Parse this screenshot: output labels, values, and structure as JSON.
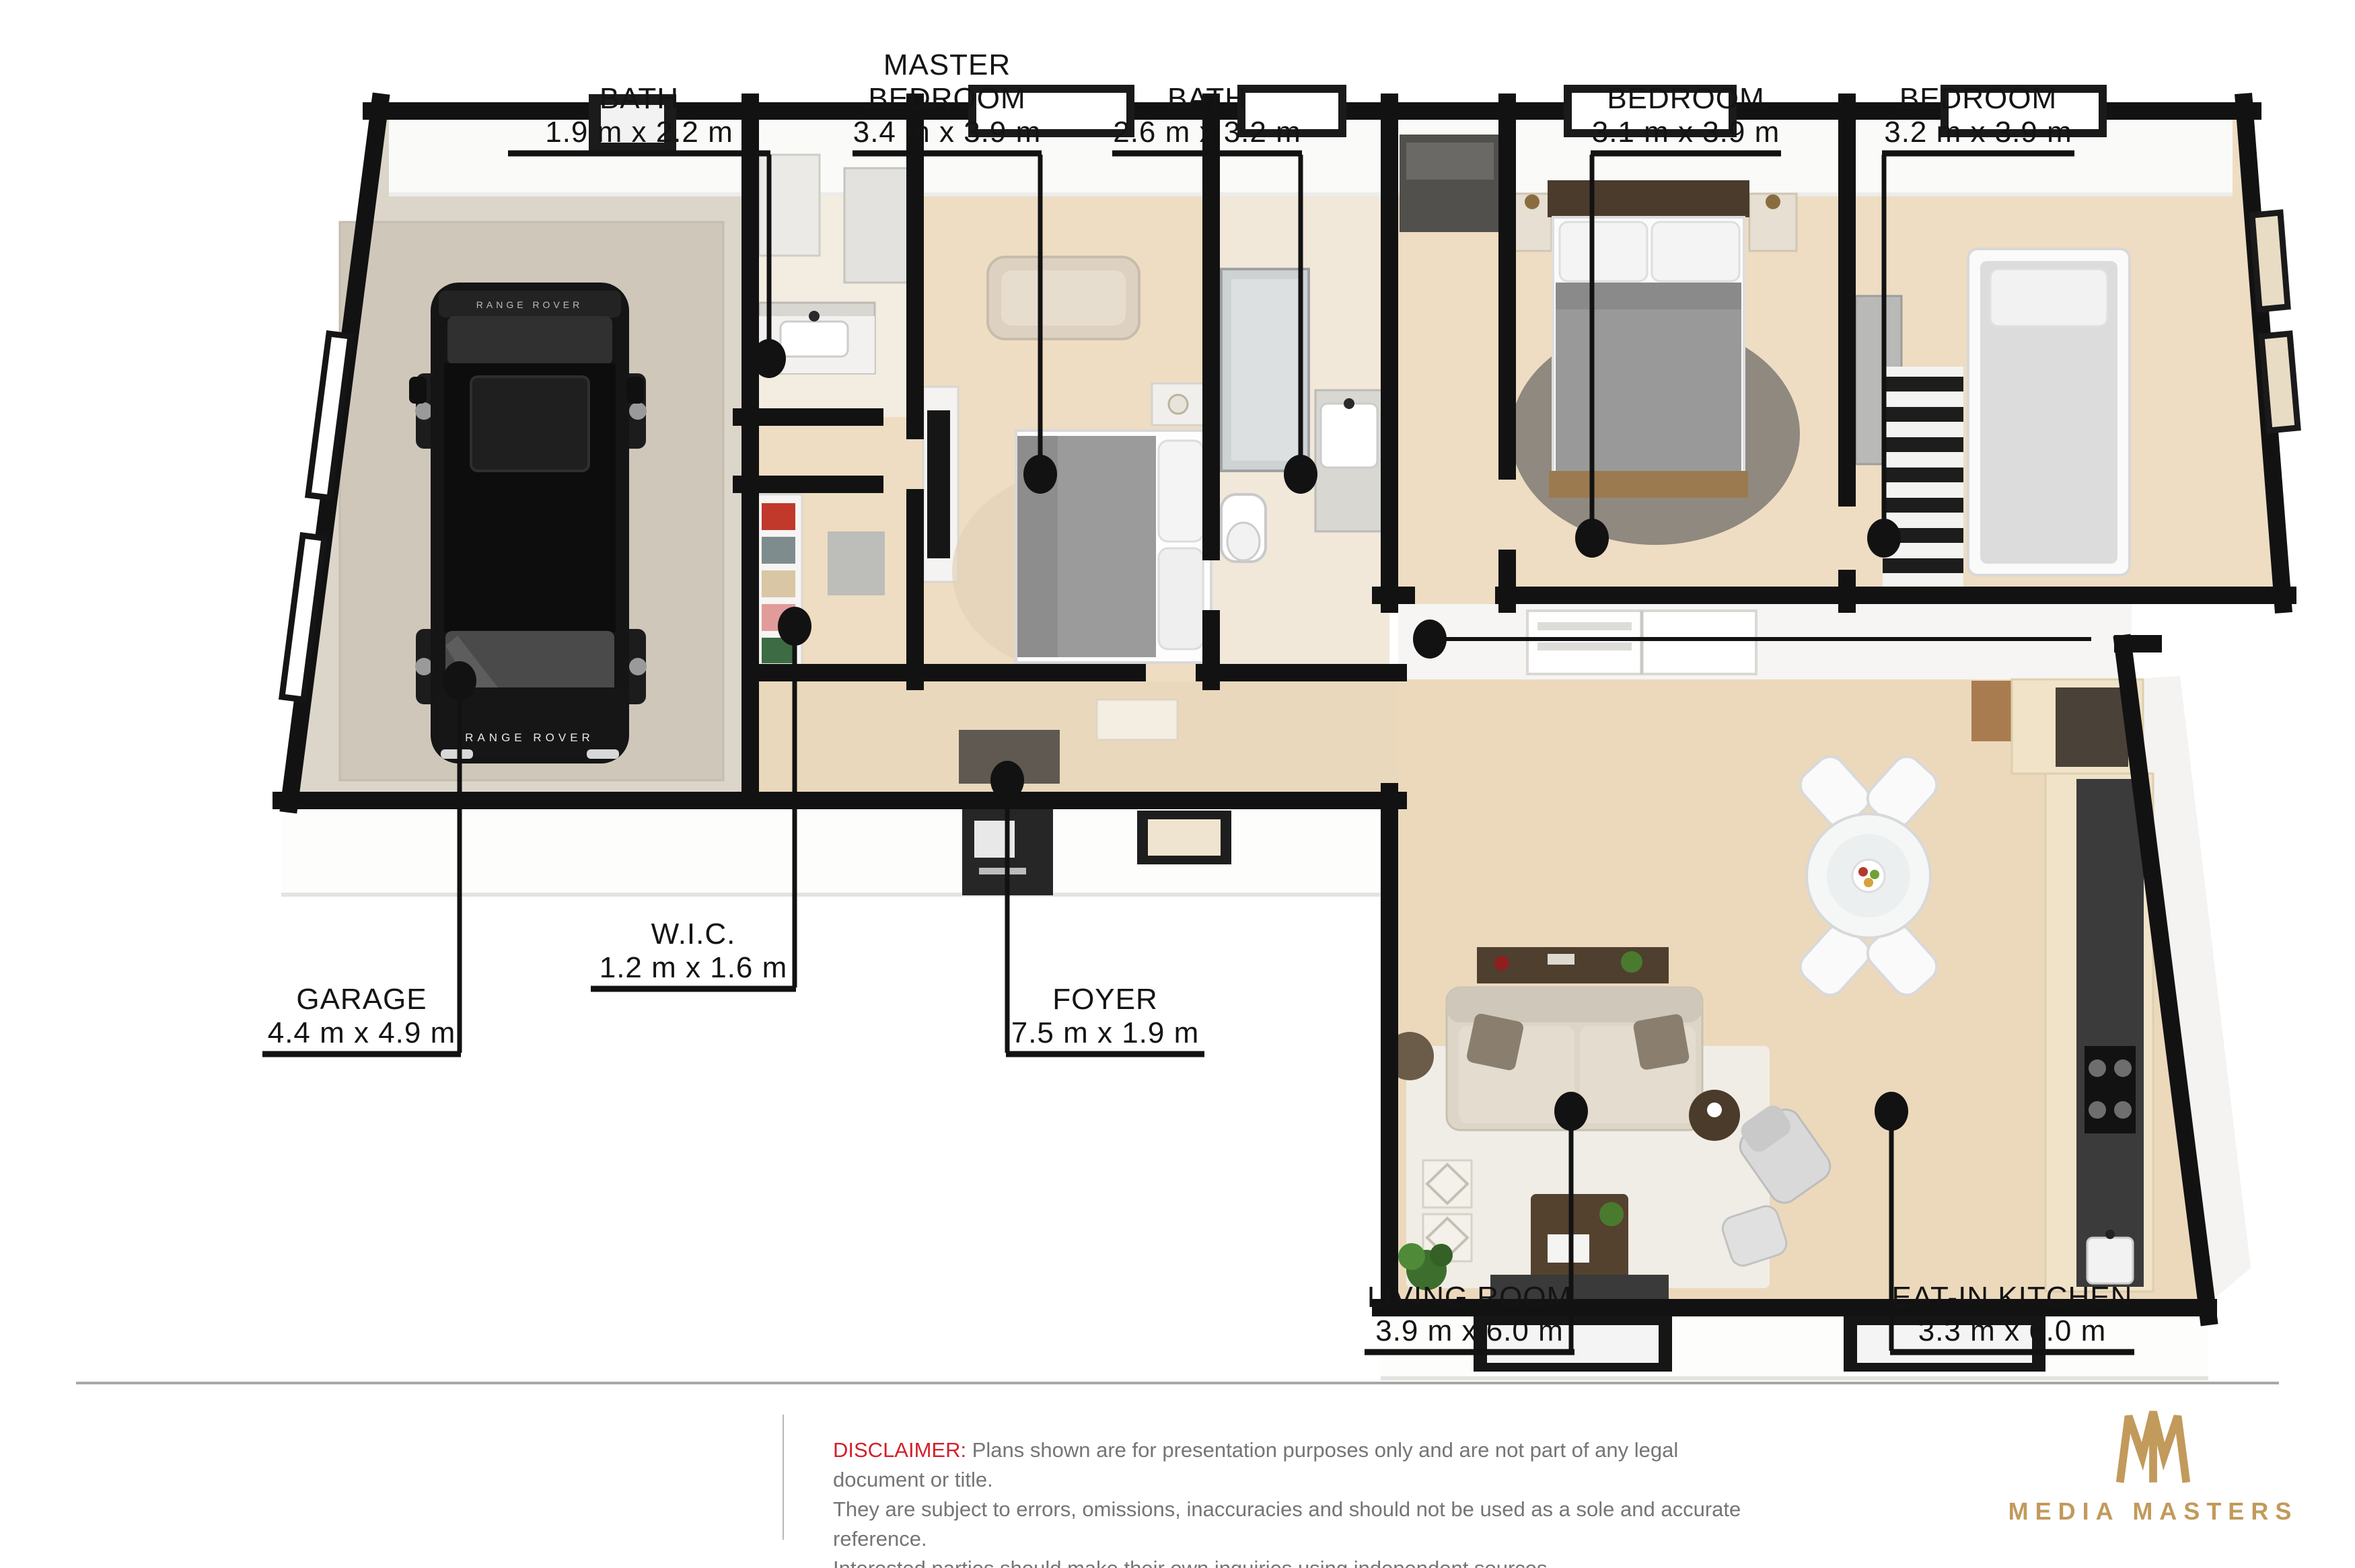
{
  "rooms": [
    {
      "id": "bath-1",
      "name": "BATH",
      "dims": "1.9 m x 2.2 m"
    },
    {
      "id": "master-bedroom",
      "name": "MASTER BEDROOM",
      "dims": "3.4 m x 3.9 m"
    },
    {
      "id": "bath-2",
      "name": "BATH",
      "dims": "2.6 m x 3.2 m"
    },
    {
      "id": "bedroom-1",
      "name": "BEDROOM",
      "dims": "3.1 m x 3.9 m"
    },
    {
      "id": "bedroom-2",
      "name": "BEDROOM",
      "dims": "3.2 m x 3.9 m"
    },
    {
      "id": "garage",
      "name": "GARAGE",
      "dims": "4.4 m x 4.9 m"
    },
    {
      "id": "wic",
      "name": "W.I.C.",
      "dims": "1.2 m x 1.6 m"
    },
    {
      "id": "foyer",
      "name": "FOYER",
      "dims": "7.5 m x 1.9 m"
    },
    {
      "id": "living-room",
      "name": "LIVING ROOM",
      "dims": "3.9 m x 6.0 m"
    },
    {
      "id": "eat-in-kitchen",
      "name": "EAT-IN KITCHEN",
      "dims": "3.3 m x 6.0 m"
    }
  ],
  "car": {
    "badge": "RANGE ROVER"
  },
  "disclaimer": {
    "label": "DISCLAIMER:",
    "lines": [
      "Plans shown are for presentation purposes only and are not part of any legal document or title.",
      "They are subject to errors, omissions, inaccuracies and should not be used as a sole and accurate reference.",
      "Interested parties should make their own inquiries using independent sources."
    ]
  },
  "branding": {
    "name": "MEDIA MASTERS",
    "icon": "crown-mm-icon",
    "color": "#c29a5b"
  },
  "colors": {
    "wall": "#121212",
    "wood_floor": "#ecd9bc",
    "garage_floor": "#d9d2c6",
    "disclaimer_red": "#d31f2a",
    "brand_gold": "#c29a5b"
  }
}
